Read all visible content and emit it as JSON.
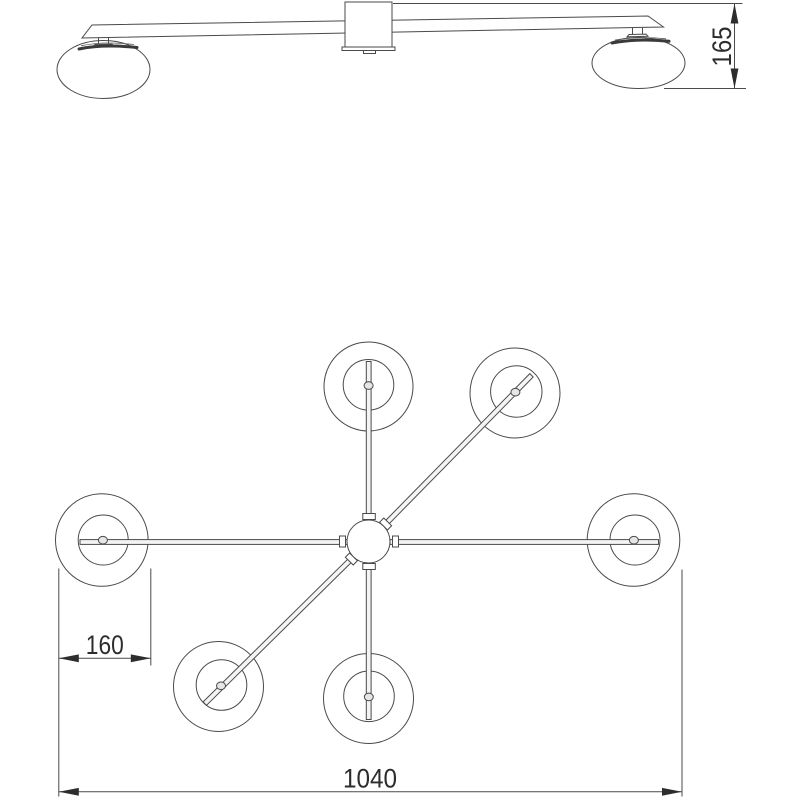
{
  "page": {
    "background_color": "#ffffff",
    "line_color": "#4a4a4a",
    "text_color": "#2d2d2d"
  },
  "drawing": {
    "kind": "technical dimension drawing",
    "subject": "ceiling light fixture with saucer glass shades",
    "side_view": {
      "lamp_count": 2
    },
    "plan_view": {
      "lamp_count": 6,
      "arm_count": 6
    },
    "dimensions": {
      "height": {
        "value": "165"
      },
      "shade_diameter": {
        "value": "160"
      },
      "overall_width": {
        "value": "1040"
      }
    }
  }
}
